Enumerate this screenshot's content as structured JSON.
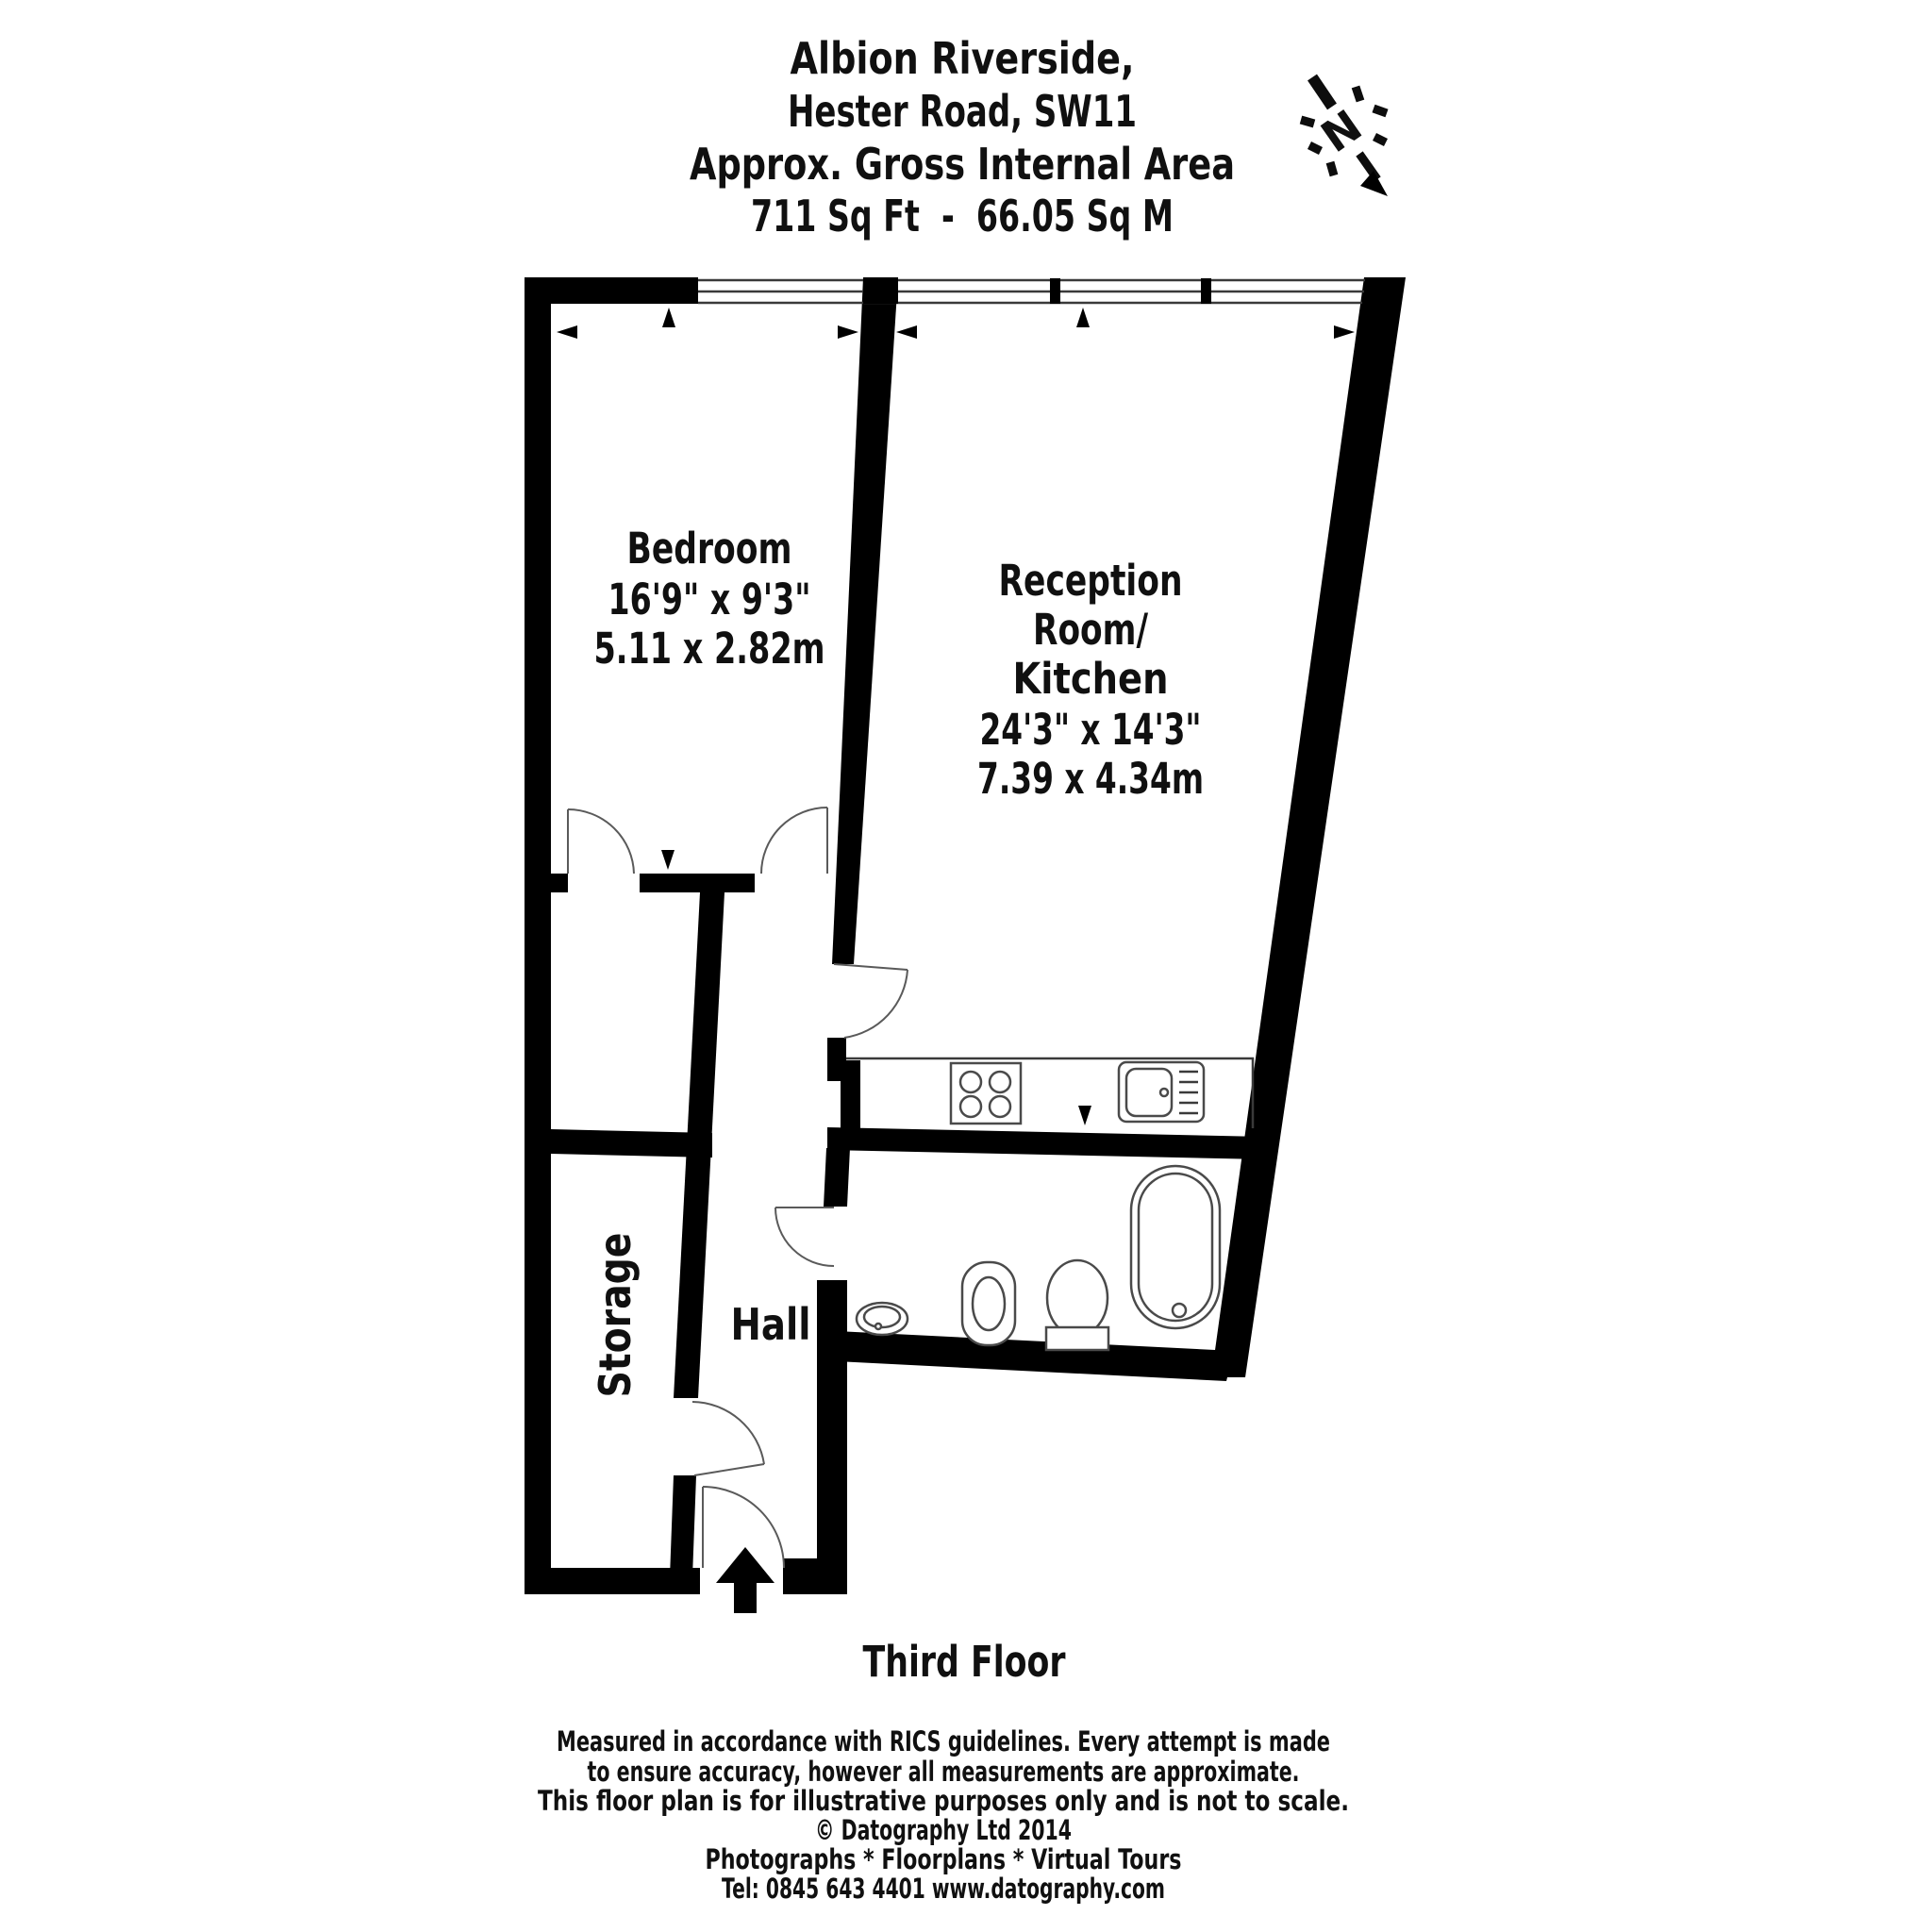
{
  "title": {
    "line1": "Albion Riverside,",
    "line2": "Hester Road, SW11",
    "line3": "Approx. Gross Internal Area",
    "line4": "711 Sq Ft  -  66.05 Sq M"
  },
  "north_indicator": {
    "label": "N"
  },
  "rooms": {
    "bedroom": {
      "name": "Bedroom",
      "size_imperial": "16'9\" x 9'3\"",
      "size_metric": "5.11 x 2.82m"
    },
    "reception": {
      "name_line1": "Reception",
      "name_line2": "Room/",
      "name_line3": "Kitchen",
      "size_imperial": "24'3\" x 14'3\"",
      "size_metric": "7.39 x 4.34m"
    },
    "hall": {
      "name": "Hall"
    },
    "storage": {
      "name": "Storage"
    }
  },
  "floor_label": "Third Floor",
  "footer": {
    "disclaimer_line1": "Measured in accordance with RICS guidelines. Every attempt is made",
    "disclaimer_line2": "to ensure accuracy, however all measurements are approximate.",
    "disclaimer_line3": "This floor plan is for illustrative purposes only and is not to scale.",
    "copyright": "© Datography Ltd 2014",
    "services": "Photographs * Floorplans * Virtual Tours",
    "contact": "Tel: 0845 643 4401 www.datography.com"
  },
  "colors": {
    "wall": "#000000",
    "line": "#4a4a4a",
    "text": "#101010",
    "background": "#ffffff"
  }
}
